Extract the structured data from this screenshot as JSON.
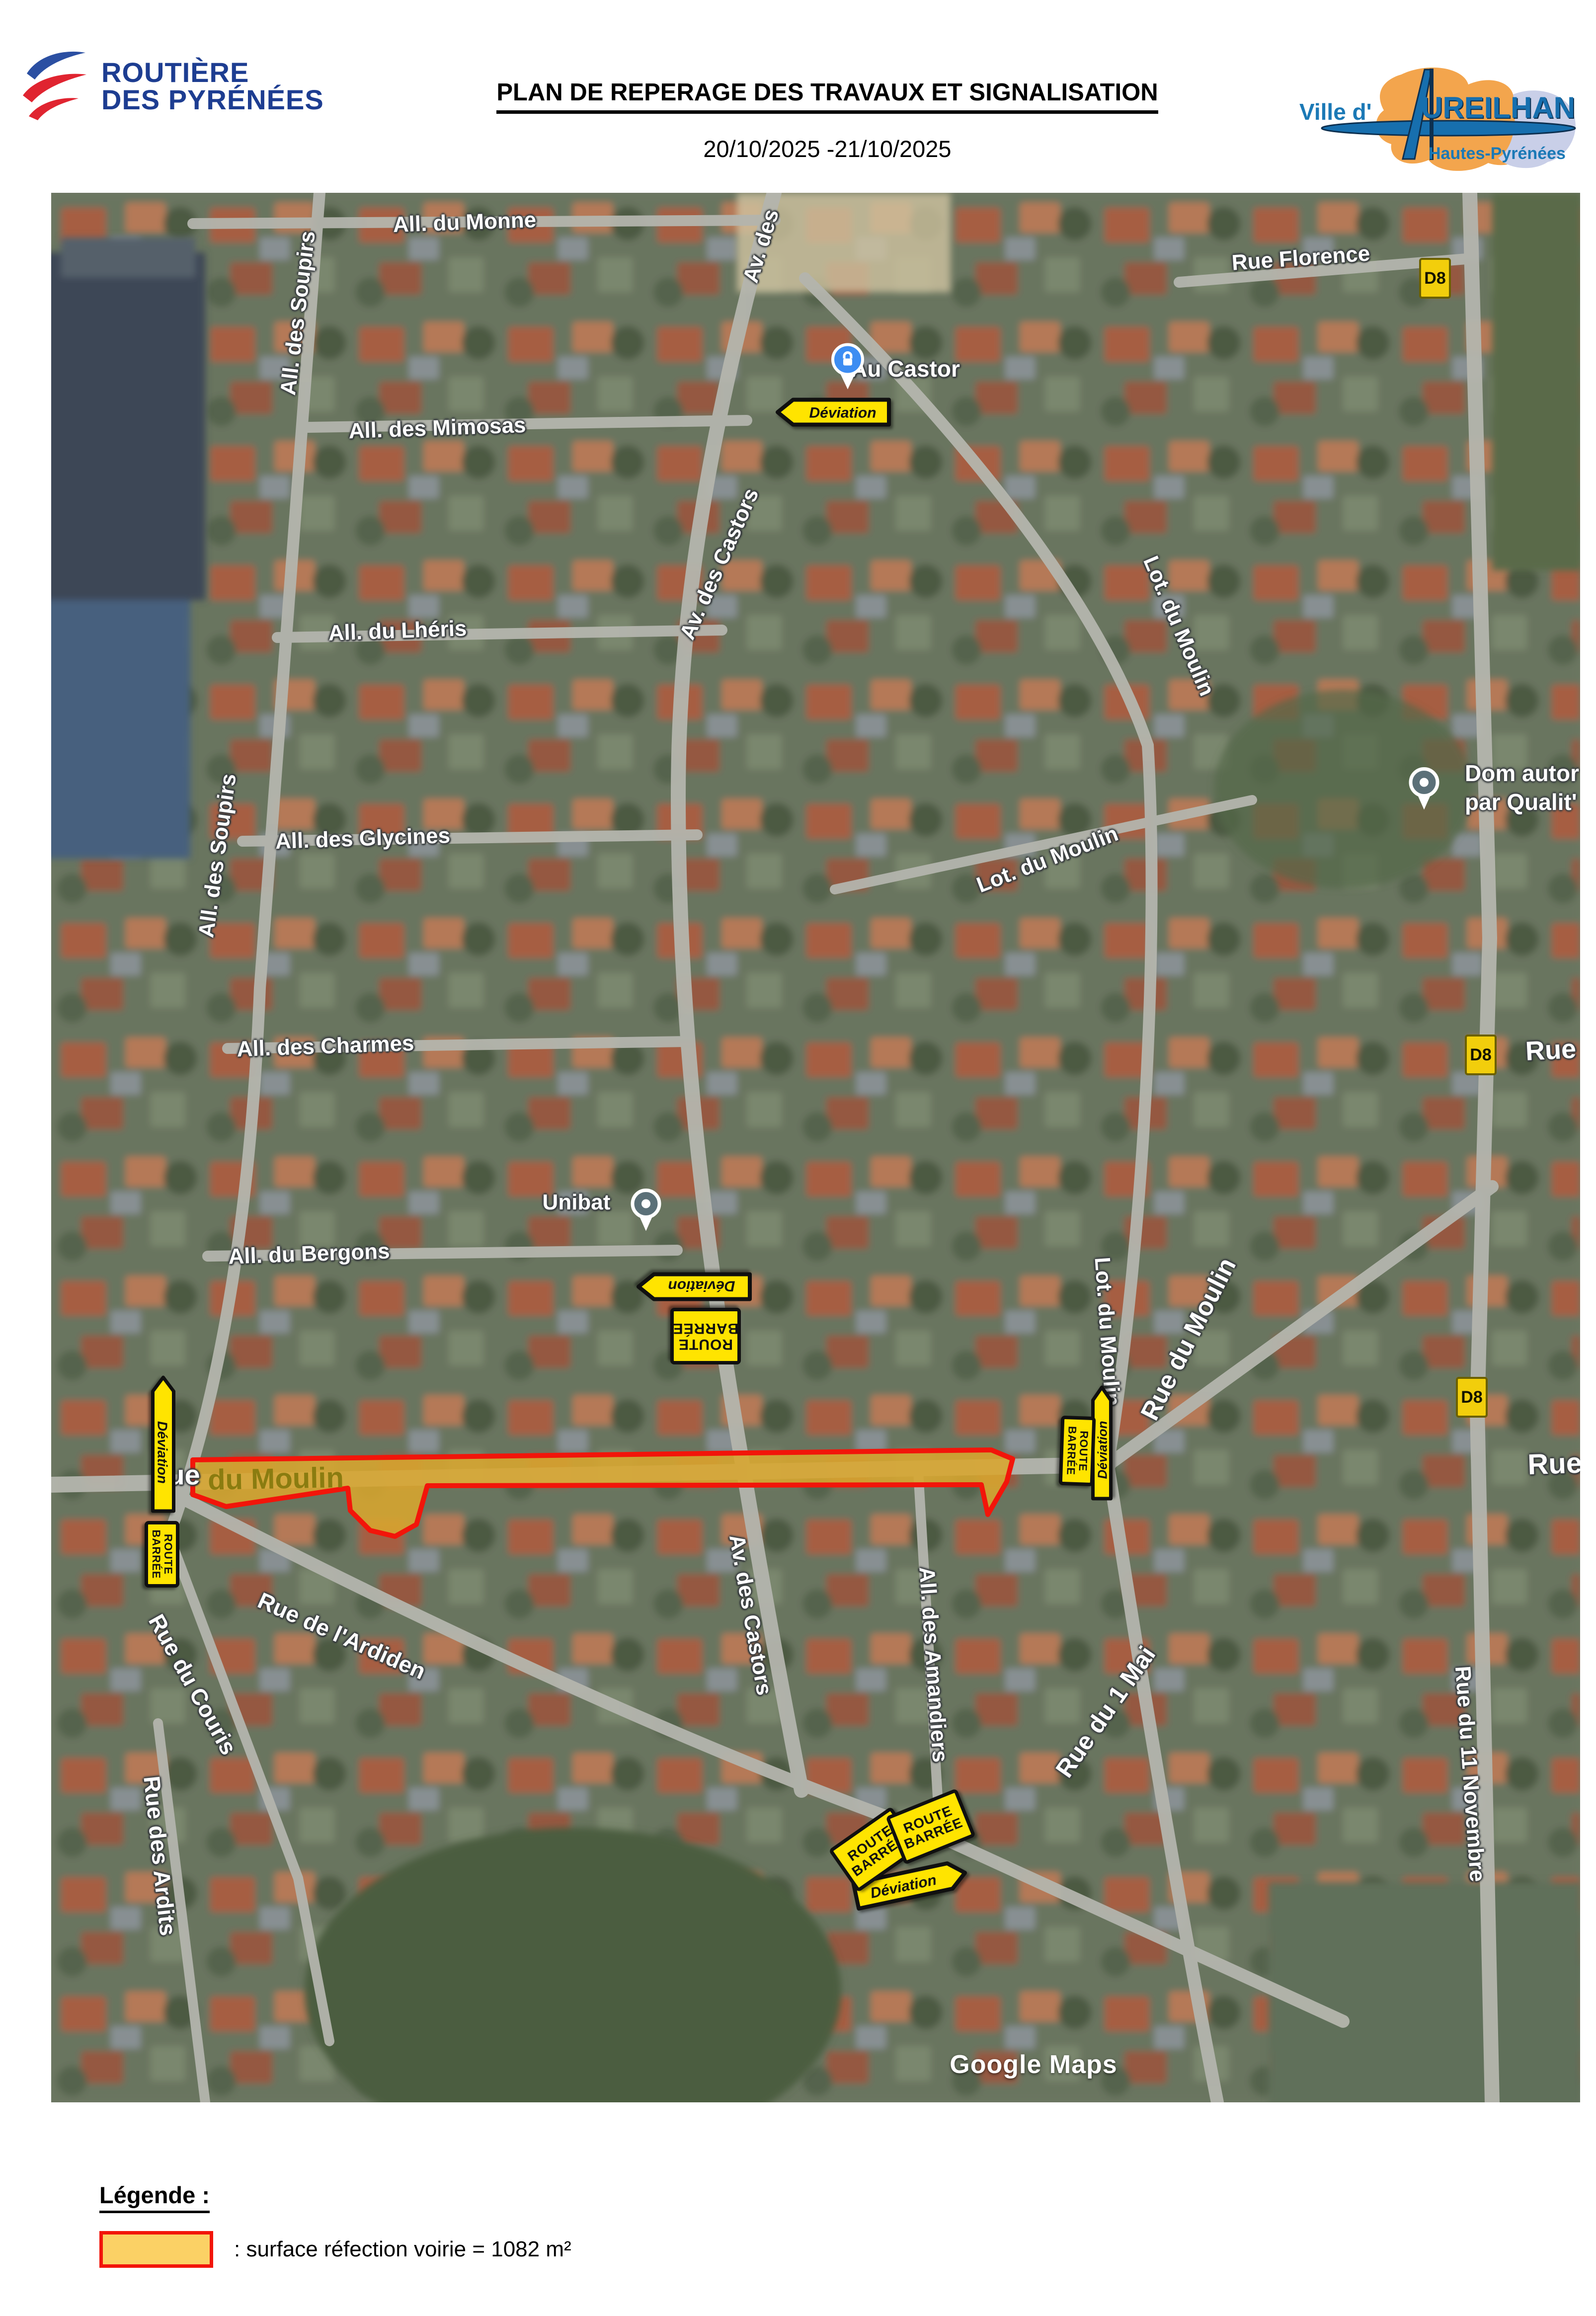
{
  "header": {
    "logo_routiere": {
      "line1": "ROUTIÈRE",
      "line2": "DES PYRÉNÉES"
    },
    "title": "PLAN DE REPERAGE DES TRAVAUX ET SIGNALISATION",
    "date_range": "20/10/2025 -21/10/2025",
    "logo_ville": {
      "prefix": "Ville d'",
      "name": "UREILHAN",
      "subtitle": "Hautes-Pyrénées"
    }
  },
  "map": {
    "watermark": "Google Maps",
    "street_labels": [
      {
        "text": "All. du Monne"
      },
      {
        "text": "All. des Soupirs"
      },
      {
        "text": "Av. des"
      },
      {
        "text": "All. des Mimosas"
      },
      {
        "text": "Rue Florence"
      },
      {
        "text": "Av. des Castors"
      },
      {
        "text": "All. du Lhéris"
      },
      {
        "text": "Lot. du Moulin"
      },
      {
        "text": "All. des Soupirs"
      },
      {
        "text": "All. des Glycines"
      },
      {
        "text": "Lot. du Moulin"
      },
      {
        "text": "All. des Charmes"
      },
      {
        "text": "Rue N"
      },
      {
        "text": "Unibat"
      },
      {
        "text": "All. du Bergons"
      },
      {
        "text": "Av. des Castors"
      },
      {
        "text": "ue"
      },
      {
        "text": "du Moulin"
      },
      {
        "text": "Lot. du Moulin"
      },
      {
        "text": "Rue du Moulin"
      },
      {
        "text": "Rue d"
      },
      {
        "text": "All. des Amandiers"
      },
      {
        "text": "Rue de l'Ardiden"
      },
      {
        "text": "Rue du Couris"
      },
      {
        "text": "Rue des Ardits"
      },
      {
        "text": "Rue du 1 Mai"
      },
      {
        "text": "Rue du 11 Novembre"
      },
      {
        "text": "Au Castor"
      }
    ],
    "signs": [
      {
        "kind": "deviation-arrow",
        "text": "Déviation"
      },
      {
        "kind": "deviation-arrow",
        "text": "Déviation"
      },
      {
        "kind": "route-barree",
        "line1": "ROUTE",
        "line2": "BARRÉE"
      },
      {
        "kind": "deviation-arrow",
        "text": "Déviation"
      },
      {
        "kind": "route-barree",
        "line1": "ROUTE",
        "line2": "BARRÉE"
      },
      {
        "kind": "route-barree",
        "line1": "ROUTE",
        "line2": "BARRÉE"
      },
      {
        "kind": "deviation-arrow",
        "text": "Déviation"
      },
      {
        "kind": "route-barree",
        "line1": "ROUTE",
        "line2": "BARRÉE"
      },
      {
        "kind": "route-barree",
        "line1": "ROUTE",
        "line2": "BARRÉE"
      },
      {
        "kind": "deviation-arrow",
        "text": "Déviation"
      }
    ],
    "badges": [
      {
        "text": "D8"
      },
      {
        "text": "D8"
      },
      {
        "text": "D8"
      }
    ],
    "pois": [
      {
        "id": "au-castor"
      },
      {
        "id": "unibat"
      },
      {
        "id": "dom-qualit",
        "line1": "Dom autor",
        "line2": "par Qualit'"
      }
    ],
    "colors": {
      "highlight_fill": "#D8A62F",
      "highlight_stroke": "#F2150A",
      "sign_yellow": "#FFE400",
      "road": "#b4b5ad"
    }
  },
  "legend": {
    "title": "Légende :",
    "description": ": surface réfection voirie = 1082 m²",
    "swatch_fill": "#FBD165",
    "swatch_border": "#F2150A"
  }
}
